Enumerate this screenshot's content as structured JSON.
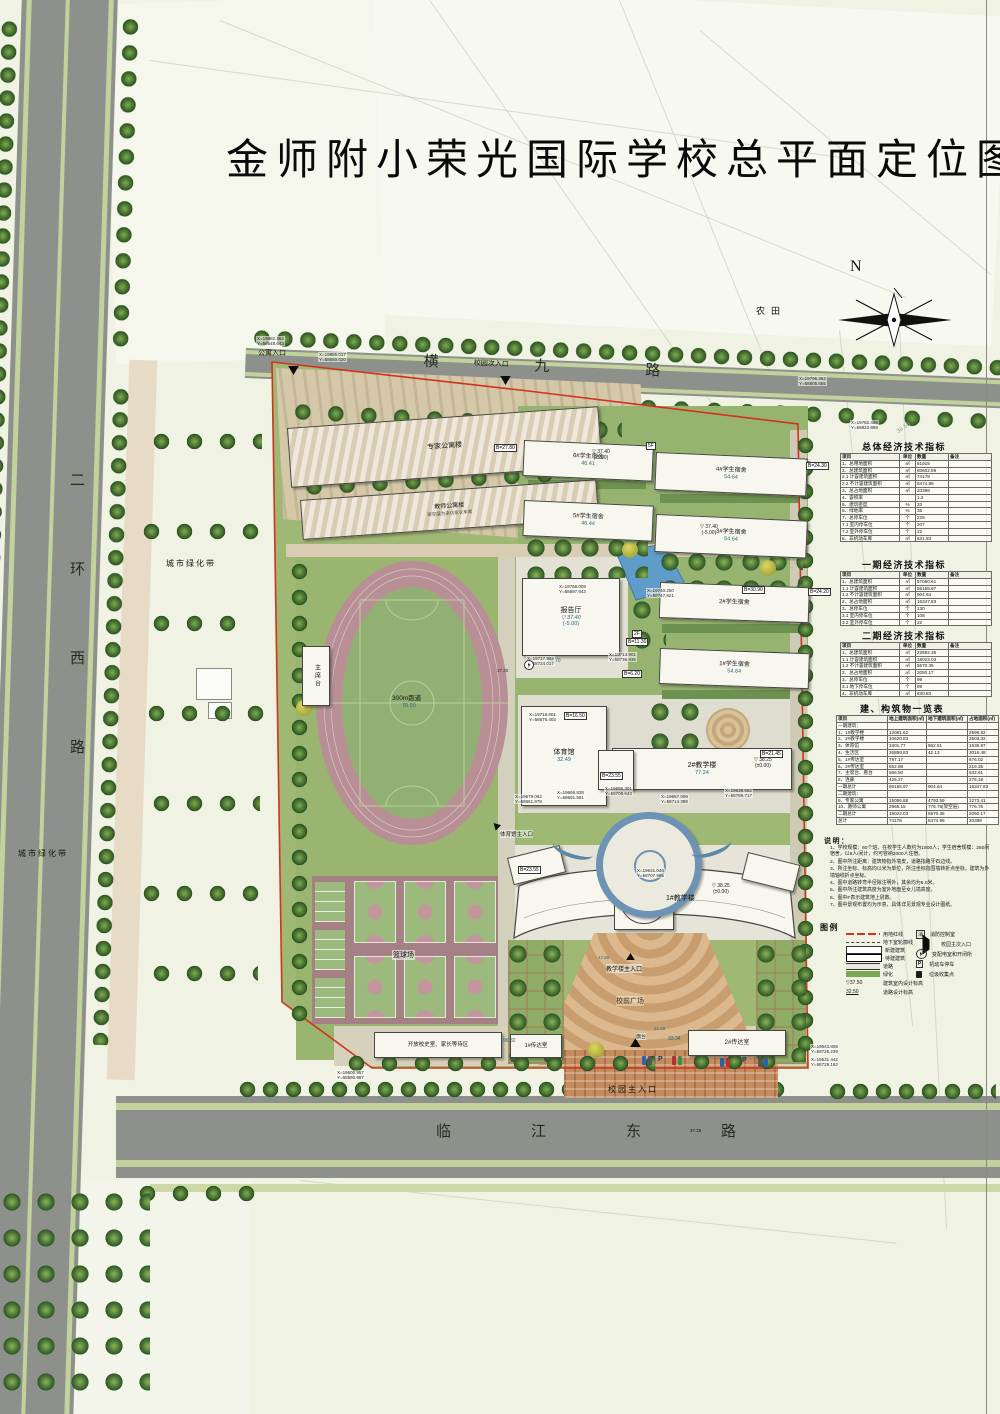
{
  "title": "金师附小荣光国际学校总平面定位图",
  "compass": {
    "label": "N"
  },
  "roads": {
    "top": "横九路",
    "left": "二环西路",
    "bottom": "临江东路",
    "bottom_elev": "37.25"
  },
  "context": {
    "farmland": "农田",
    "green_belt_west": "城市绿化带",
    "green_belt_southwest": "城市绿化带"
  },
  "entrances": {
    "apartment": "公寓入口",
    "secondary": "校园次入口",
    "main": "校园主入口",
    "teaching": "教学楼主入口",
    "gym": "体育馆主入口"
  },
  "buildings": {
    "expert_apartment": "专家公寓楼",
    "teacher_apartment": "教师公寓楼",
    "teacher_apartment_note": "架空层为来访家长车库",
    "dorm6": "6#学生宿舍",
    "dorm5": "5#学生宿舍",
    "dorm4": "4#学生宿舍",
    "dorm3": "3#学生宿舍",
    "dorm2": "2#学生宿舍",
    "dorm1": "1#学生宿舍",
    "hall": "报告厅",
    "gym": "体育馆",
    "teach2": "2#教学楼",
    "teach1": "1#教学楼",
    "observatory": "天文台",
    "rostrum": "主席台",
    "track": "300m跑道",
    "basketball": "篮球场",
    "open_room": "开放校史室、家长等待区",
    "gate1": "1#传达室",
    "gate2": "2#传达室",
    "front_plaza": "校前广场",
    "flag": "旗台"
  },
  "dims": {
    "dorm6_len": "46.41",
    "dorm5_len": "46.44",
    "dorm4_len": "54.64",
    "dorm3_len": "54.64",
    "dorm1_len": "54.64",
    "hall_len": "56.70",
    "gym_len": "32.49",
    "teach2_len": "77.24",
    "open_len": "96.32",
    "gate2_len": "33.34",
    "track_len": "70.00",
    "obs_val": "112.92",
    "flag_len": "21.00",
    "plaza_elev": "17.80",
    "road_elev": "37.30",
    "survey": "36.56"
  },
  "levels": {
    "tri": "▽",
    "l1v": "37.40",
    "l1b": "(-5.00)",
    "l2v": "38.25",
    "l2b": "(±0.00)"
  },
  "tags": [
    "5F",
    "2F",
    "B=27.80",
    "B=24.30",
    "B=24.20",
    "B=30.90",
    "B=11.30",
    "B=23.55",
    "B=23.55",
    "B=21.45",
    "B=16.50",
    "B=6.20"
  ],
  "misc": {
    "p": "P"
  },
  "coords": [
    {
      "x": "X=19882.352",
      "y": "Y=58648.643"
    },
    {
      "x": "X=19885.017",
      "y": "Y=58650.020"
    },
    {
      "x": "X=19796.362",
      "y": "Y=58805.665"
    },
    {
      "x": "X=19782.468",
      "y": "Y=58822.898"
    },
    {
      "x": "X=19768.009",
      "y": "Y=58697.943"
    },
    {
      "x": "X=19740.250",
      "y": "Y=58747.821"
    },
    {
      "x": "X=19717.952",
      "y": "Y=58724.017"
    },
    {
      "x": "X=19713.901",
      "y": "Y=58736.935"
    },
    {
      "x": "X=19718.801",
      "y": "Y=58676.403"
    },
    {
      "x": "X=19679.062",
      "y": "Y=58661.978"
    },
    {
      "x": "X=19666.838",
      "y": "Y=58691.591"
    },
    {
      "x": "X=19656.301",
      "y": "Y=58708.643"
    },
    {
      "x": "X=19657.009",
      "y": "Y=58714.388"
    },
    {
      "x": "X=19638.662",
      "y": "Y=58759.717"
    },
    {
      "x": "X=19631.046",
      "y": "Y=58707.985"
    },
    {
      "x": "X=19600.957",
      "y": "Y=58560.987"
    },
    {
      "x": "X=19543.808",
      "y": "Y=58725.239"
    },
    {
      "x": "X=19531.442",
      "y": "Y=58729.162"
    }
  ],
  "tables": {
    "overall": {
      "title": "总体经济技术指标",
      "headers": [
        "项目",
        "单位",
        "数量",
        "备注"
      ],
      "rows": [
        [
          "1、总用地面积",
          "㎡",
          "61915",
          ""
        ],
        [
          "2、总建筑面积",
          "㎡",
          "80602.99",
          ""
        ],
        [
          "2.1 计容建筑面积",
          "㎡",
          "74178",
          ""
        ],
        [
          "2.2 不计容建筑面积",
          "㎡",
          "6474.99",
          ""
        ],
        [
          "3、总占地面积",
          "㎡",
          "20398",
          ""
        ],
        [
          "4、容积率",
          "",
          "1.2",
          ""
        ],
        [
          "5、建筑密度",
          "%",
          "33",
          ""
        ],
        [
          "6、绿地率",
          "%",
          "35",
          ""
        ],
        [
          "7、总停车位",
          "个",
          "229",
          ""
        ],
        [
          "7.1 室内停车位",
          "个",
          "207",
          ""
        ],
        [
          "7.2 室外停车位",
          "个",
          "22",
          ""
        ],
        [
          "8、非机动车库",
          "㎡",
          "631.93",
          ""
        ]
      ]
    },
    "phase1": {
      "title": "一期经济技术指标",
      "headers": [
        "项目",
        "单位",
        "数量",
        "备注"
      ],
      "rows": [
        [
          "1、总建筑面积",
          "㎡",
          "57060.61",
          ""
        ],
        [
          "1.1 计容建筑面积",
          "㎡",
          "56155.97",
          ""
        ],
        [
          "1.2 不计容建筑面积",
          "㎡",
          "904.64",
          ""
        ],
        [
          "2、总占地面积",
          "㎡",
          "16347.83",
          ""
        ],
        [
          "3、总停车位",
          "个",
          "130",
          ""
        ],
        [
          "3.1 室内停车位",
          "个",
          "108",
          ""
        ],
        [
          "3.2 室外停车位",
          "个",
          "22",
          ""
        ]
      ]
    },
    "phase2": {
      "title": "二期经济技术指标",
      "headers": [
        "项目",
        "单位",
        "数量",
        "备注"
      ],
      "rows": [
        [
          "1、总建筑面积",
          "㎡",
          "23592.38",
          ""
        ],
        [
          "1.1 计容建筑面积",
          "㎡",
          "18022.03",
          ""
        ],
        [
          "1.2 不计容建筑面积",
          "㎡",
          "5570.35",
          ""
        ],
        [
          "2、总占地面积",
          "㎡",
          "2050.17",
          ""
        ],
        [
          "3、总停车位",
          "个",
          "99",
          ""
        ],
        [
          "3.1 地下停车位",
          "个",
          "99",
          ""
        ],
        [
          "4、非机动车库",
          "㎡",
          "630.83",
          ""
        ]
      ]
    },
    "blds": {
      "title": "建、构筑物一览表",
      "headers": [
        "项目",
        "地上建筑面积(㎡)",
        "地下建筑面积(㎡)",
        "占地面积(㎡)"
      ],
      "rows": [
        [
          "一期建筑：",
          "",
          "",
          ""
        ],
        [
          "1、1#教学楼",
          "12081.62",
          "",
          "2598.82"
        ],
        [
          "2、2#教学楼",
          "10620.83",
          "",
          "2503.32"
        ],
        [
          "3、体育馆",
          "3401.77",
          "862.51",
          "1536.97"
        ],
        [
          "4、生活区",
          "26899.83",
          "42.13",
          "3016.48"
        ],
        [
          "5、1#传达室",
          "797.17",
          "",
          "676.02"
        ],
        [
          "6、2#传达室",
          "652.98",
          "",
          "219.35"
        ],
        [
          "7、主席台、看台",
          "666.50",
          "",
          "532.61"
        ],
        [
          "8、连廊",
          "425.27",
          "",
          "275.18"
        ],
        [
          "一期总计",
          "56155.97",
          "904.64",
          "16347.83"
        ],
        [
          "二期建筑：",
          "",
          "",
          ""
        ],
        [
          "9、专家公寓",
          "15056.88",
          "4793.59",
          "1273.41"
        ],
        [
          "10、教师公寓",
          "2965.15",
          "776.76(架空层)",
          "776.76"
        ],
        [
          "二期总计",
          "18022.03",
          "5570.35",
          "2050.17"
        ],
        [
          "总计",
          "74178",
          "6474.99",
          "20398"
        ]
      ]
    }
  },
  "notes": {
    "title": "说明：",
    "items": [
      "1、学校规模：60个班，在校学生人数约为1800人；学生宿舍规模：250间宿舍，以8人/间计，约可容纳2000人住宿。",
      "2、图中所注距离：建筑物指外墙皮，道路指路牙石边线。",
      "3、所注坐标、标高均以米为单位，所注坐标指围墙转折点坐标，建筑为外墙轴线折点坐标。",
      "4、图中道路转弯半径除注明外，其余均为6.0米。",
      "5、图中所注建筑高度为室外地面至女儿墙高度。",
      "6、图中F表示建筑地上层数。",
      "7、图中景观布置均为示意，具体详见景观专业设计图纸。"
    ]
  },
  "legend": {
    "title": "图例",
    "left": [
      {
        "label": "用地红线"
      },
      {
        "label": "地下室轮廓线"
      },
      {
        "label": "新建建筑"
      },
      {
        "label": "待建建筑"
      },
      {
        "label": "道路"
      },
      {
        "label": "绿化"
      },
      {
        "label": "建筑室内设计标高",
        "sym": "▽37.50"
      },
      {
        "label": "道路设计标高",
        "sym": "32.50"
      }
    ],
    "right": [
      {
        "label": "消防控制室",
        "sym": "消"
      },
      {
        "label": "校园主次入口"
      },
      {
        "label": "变配电室和开闭所"
      },
      {
        "label": "机动车停车",
        "sym": "P"
      },
      {
        "label": "垃圾收集点"
      }
    ]
  }
}
